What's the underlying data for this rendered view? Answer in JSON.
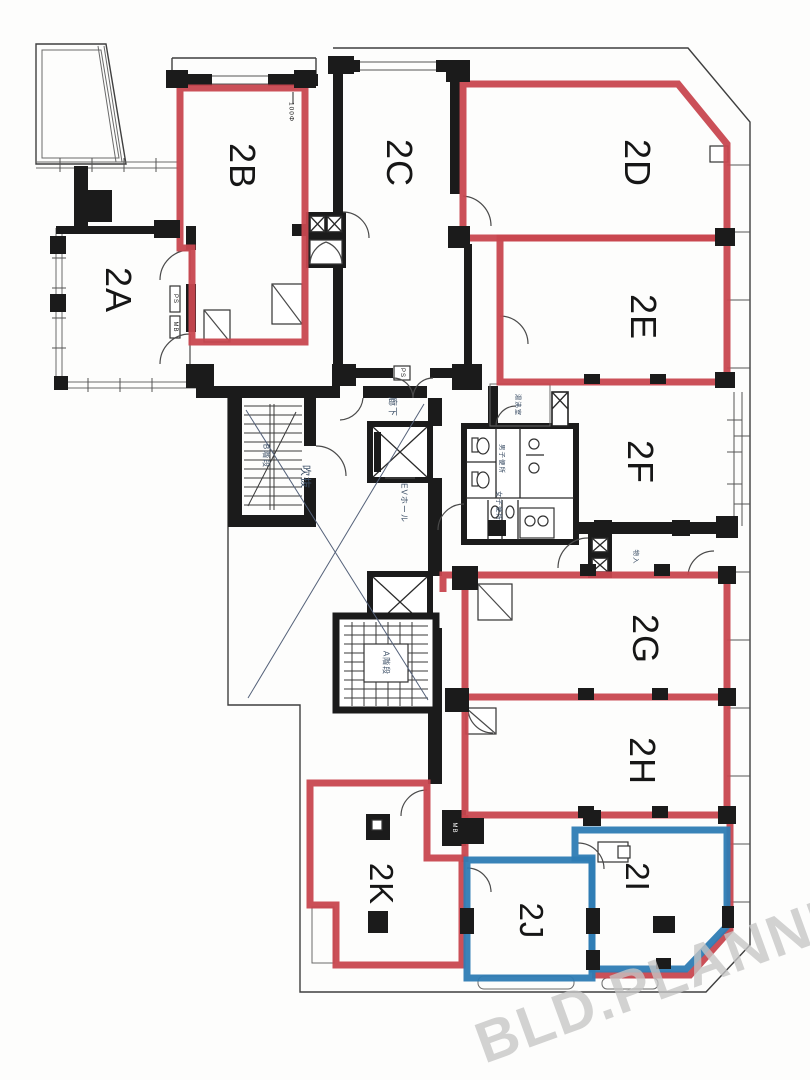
{
  "colors": {
    "red": "#c8474f",
    "blue": "#2e7cb4",
    "wall": "#1b1b1b",
    "label_blue": "#3c4f66",
    "watermark": "#c6c6c6"
  },
  "rooms": [
    {
      "id": "2A",
      "label": "2A",
      "highlight": "none"
    },
    {
      "id": "2B",
      "label": "2B",
      "highlight": "red"
    },
    {
      "id": "2C",
      "label": "2C",
      "highlight": "none"
    },
    {
      "id": "2D",
      "label": "2D",
      "highlight": "red"
    },
    {
      "id": "2E",
      "label": "2E",
      "highlight": "red"
    },
    {
      "id": "2F",
      "label": "2F",
      "highlight": "none"
    },
    {
      "id": "2G",
      "label": "2G",
      "highlight": "red"
    },
    {
      "id": "2H",
      "label": "2H",
      "highlight": "red"
    },
    {
      "id": "2I",
      "label": "2I",
      "highlight": "blue"
    },
    {
      "id": "2J",
      "label": "2J",
      "highlight": "blue"
    },
    {
      "id": "2K",
      "label": "2K",
      "highlight": "red"
    }
  ],
  "core": {
    "corridor": "廊下",
    "void": "吹抜",
    "ev_hall": "EVホール",
    "stair_a": "A階段",
    "stair_b": "B階段",
    "mens_wc": "男子便所",
    "womens_wc": "女子便所",
    "kitchenette": "湯沸室",
    "storage": "物入",
    "ps": "PS",
    "mb": "MB",
    "pipe": "100Φ"
  },
  "watermark": {
    "text": "BLD.PLANNER"
  }
}
